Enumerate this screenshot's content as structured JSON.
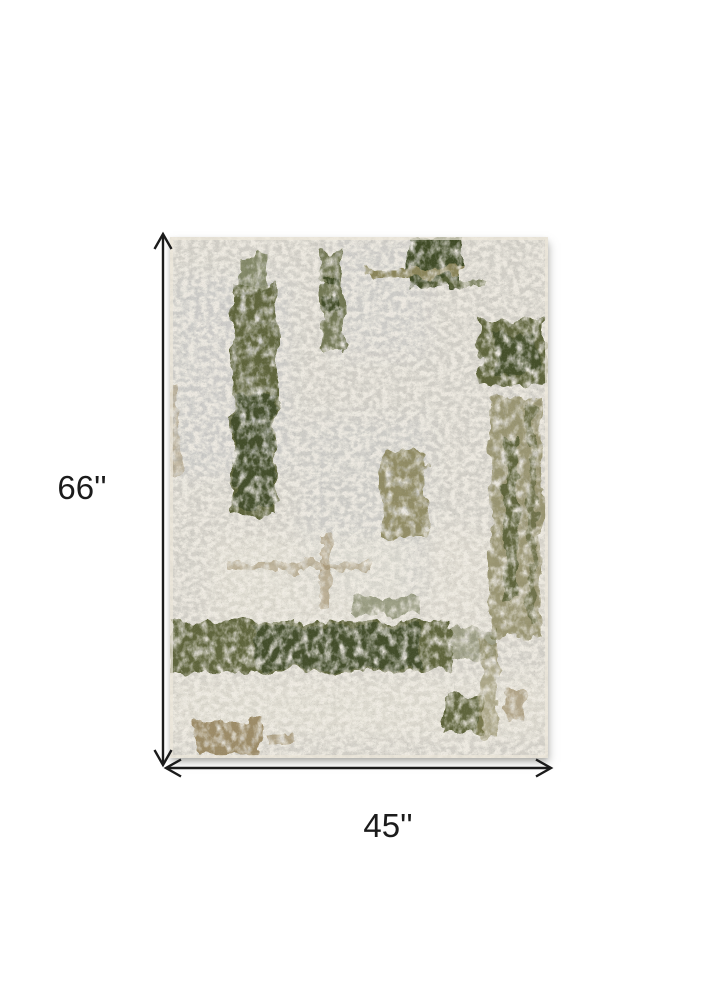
{
  "figure": {
    "type": "product-dimension-diagram",
    "product": "Abstract distressed area rug in ivory, grey and olive green",
    "height_label": "66''",
    "width_label": "45''",
    "height_inches": 66,
    "width_inches": 45
  },
  "colors": {
    "canvas_bg": "#ffffff",
    "dimension_line": "#1b1b1b",
    "label_text": "#1b1b1b",
    "rug_base": "#d6d3cb",
    "rug_cream": "#ece7da",
    "rug_grey": "#c9cccd",
    "rug_olive": "#5d6438",
    "rug_olive_light": "#8a8457",
    "rug_dark_green": "#3c4824",
    "rug_tan": "#9e8c66"
  }
}
